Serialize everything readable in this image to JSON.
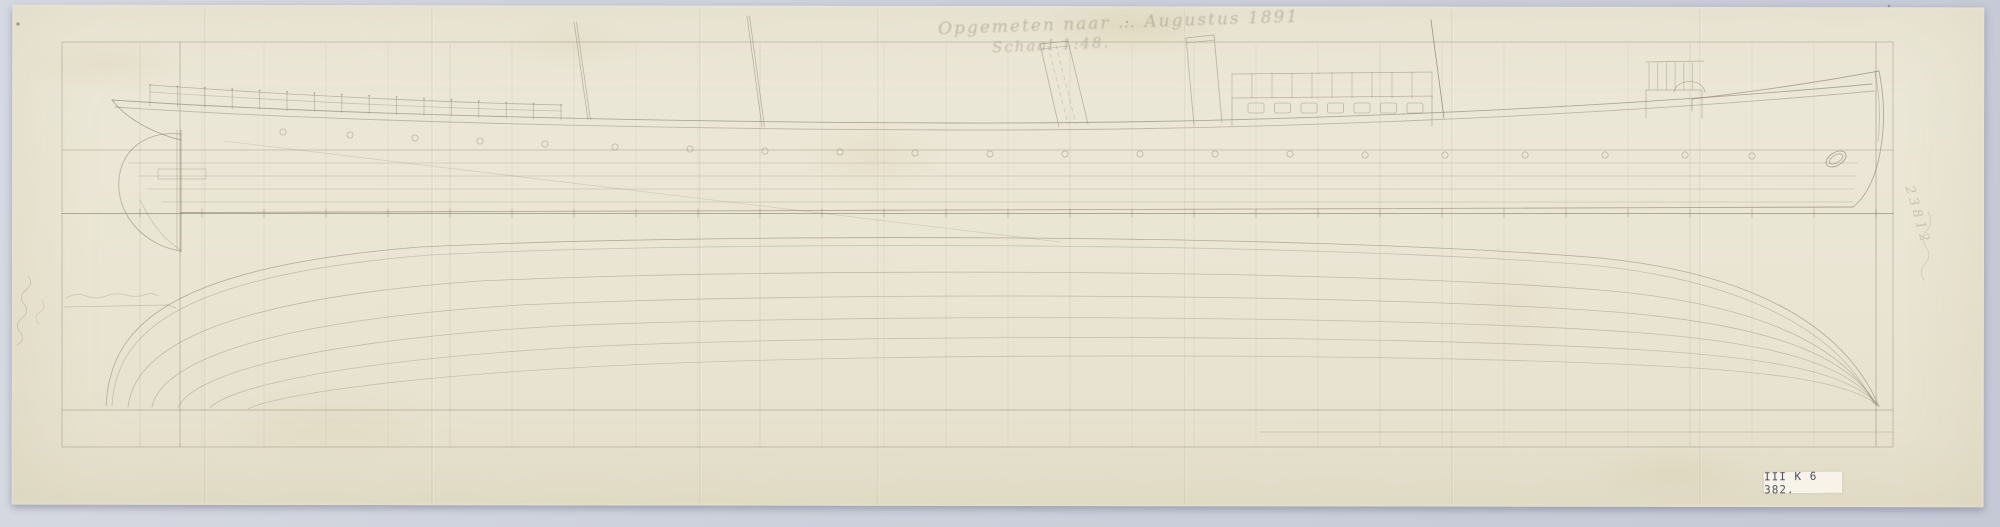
{
  "inscription": {
    "line1": "Opgemeten naar … Augustus 1891",
    "line2": "Schaal 1:48."
  },
  "stamp": {
    "text": "III K 6 382."
  },
  "margin": {
    "vertical_number": "23812"
  },
  "colors": {
    "background": "#cdd1dc",
    "paper": "#eae5d3",
    "pencil": "#857e6a",
    "stamp_text": "#4e525e"
  }
}
